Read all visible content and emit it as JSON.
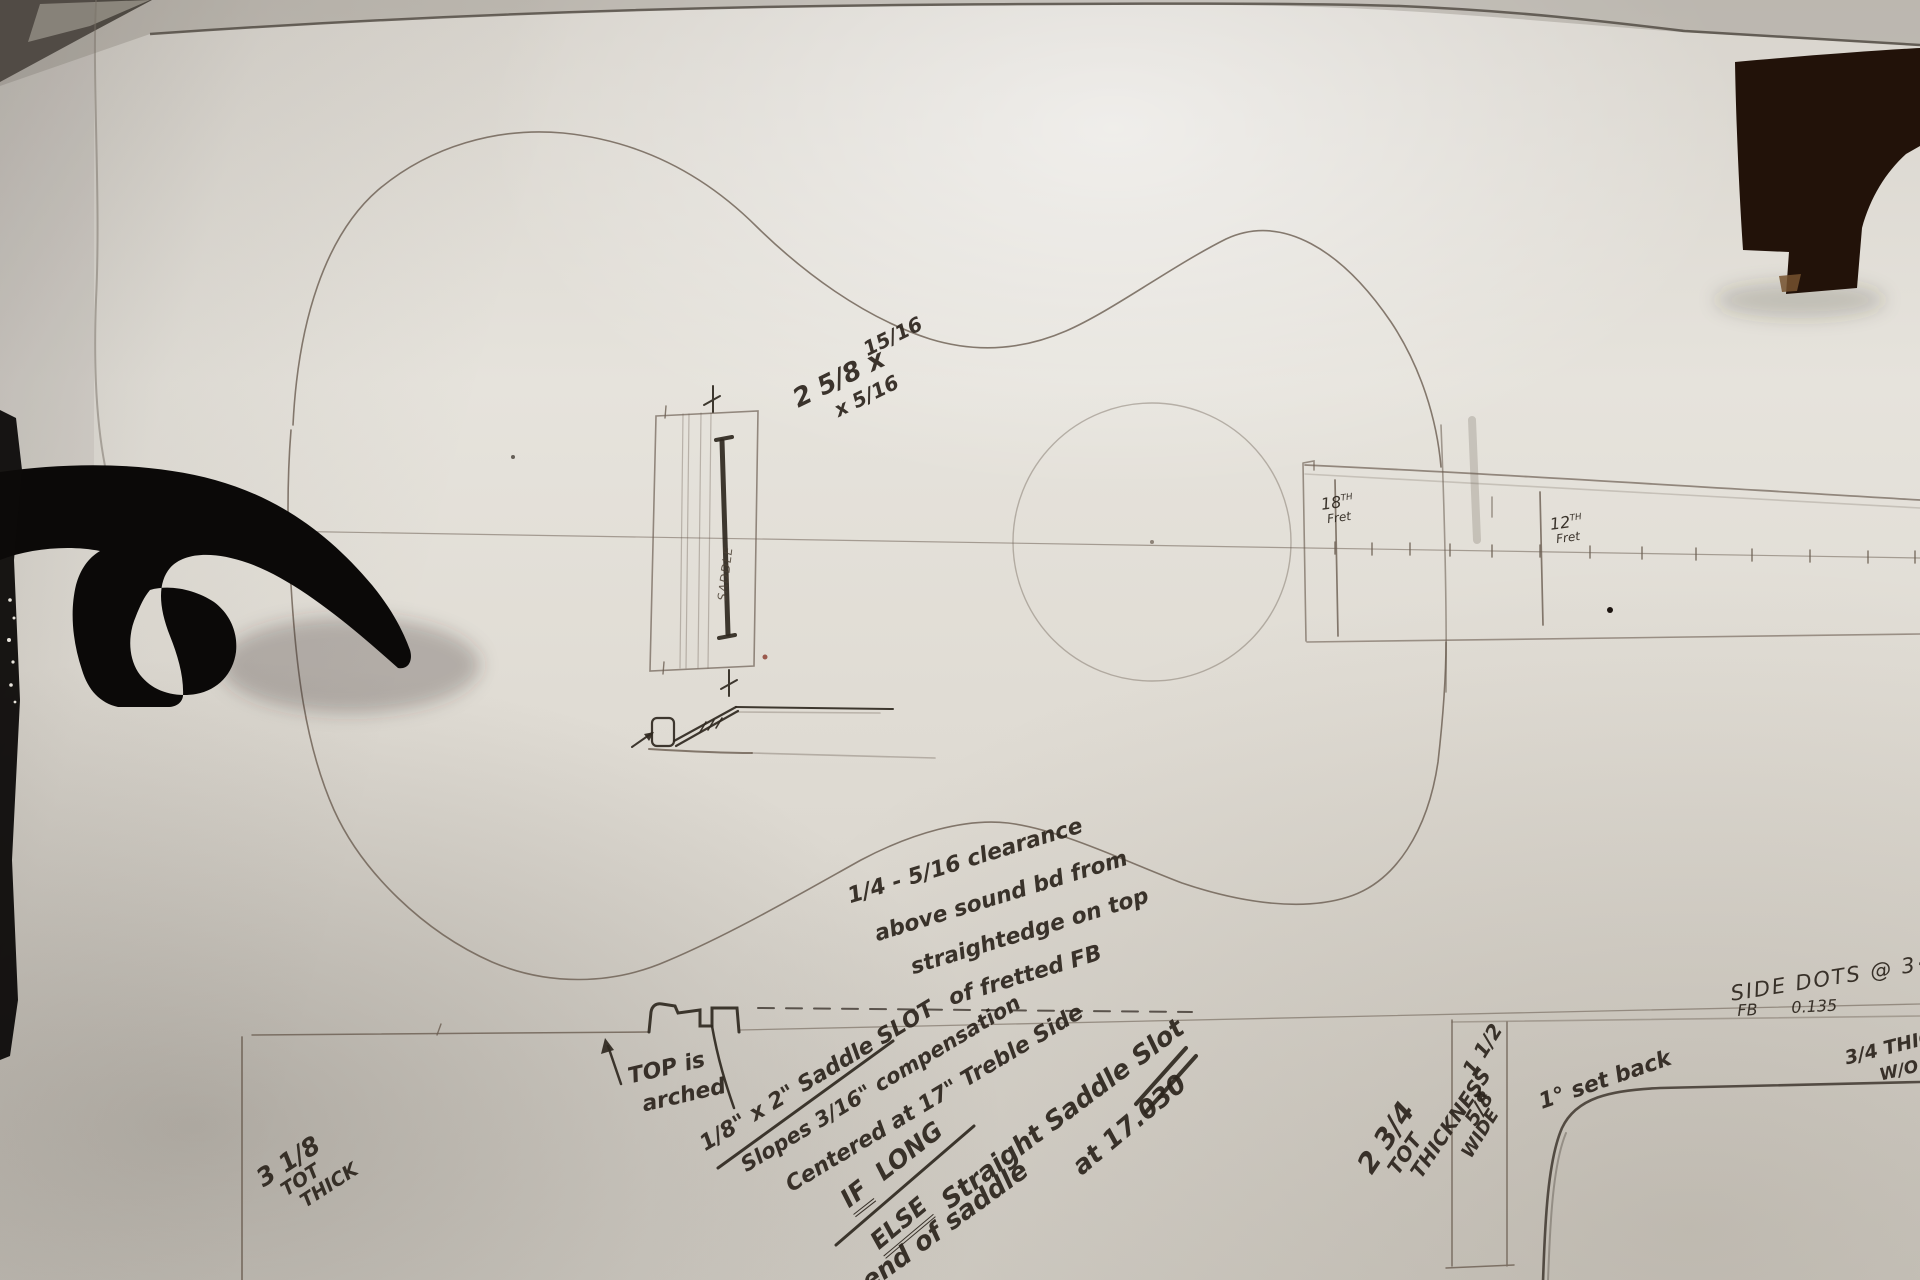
{
  "bridge": {
    "dim_l1": "2 5/8 x",
    "dim_l2": "15/16",
    "dim_l3": "x 5/16",
    "saddle_label": "SADDLE"
  },
  "frets": {
    "f18_num": "18",
    "f18_ord": "TH",
    "f18_word": "Fret",
    "f12_num": "12",
    "f12_ord": "TH",
    "f12_word": "Fret"
  },
  "clearance": {
    "l1": "1/4 - 5/16 clearance",
    "l2": "above sound bd from",
    "l3": "straightedge on top",
    "l4": "of fretted FB"
  },
  "arch": {
    "l1": "TOP is",
    "l2": "arched"
  },
  "slot": {
    "size_line": "1/8\" x 2\"  Saddle SLOT",
    "slope_line": "Slopes 3/16\" compensation",
    "center_line": "Centered at 17\" Treble Side",
    "if_word": "IF",
    "long_word": "LONG",
    "else_word": "ELSE",
    "straight_line": "Straight Saddle Slot",
    "end_line": "end of saddle",
    "at_line": "at 17.030"
  },
  "body_depth": {
    "l1": "3 1/8",
    "l2": "TOT",
    "l3": "THICK"
  },
  "neck": {
    "thick_l1": "2 3/4",
    "thick_l2": "TOT",
    "thick_l3": "THICKNESS",
    "box_l1": "1 1/2",
    "box_l2": "x",
    "box_l3": "5/8",
    "box_l4": "WIDE",
    "setback": "1° set back"
  },
  "fretboard_notes": {
    "side_dots": "SIDE DOTS @ 3·5·7-",
    "fb_label": "FB",
    "fb_value": "0.135",
    "thick_l1": "3/4 THIC",
    "thick_l2": "W/O"
  }
}
